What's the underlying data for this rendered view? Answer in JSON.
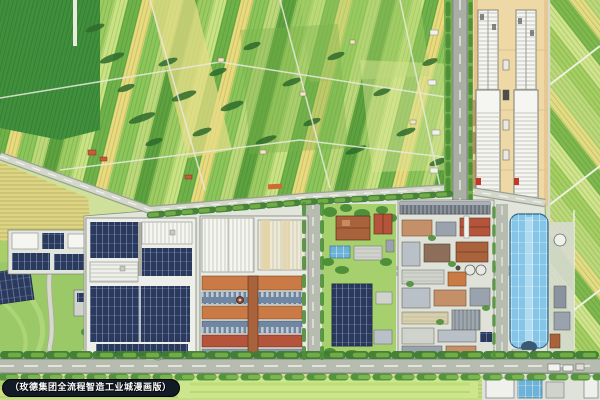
{
  "caption": {
    "label": "（玫德集团全流程智造工业城漫画版）"
  },
  "palette": {
    "farm_green": "#8cc65a",
    "farm_green_dark": "#3f8f3c",
    "farm_yellow": "#e9da7d",
    "hedge_dark": "#2f6b2c",
    "road_gray": "#b7bcb0",
    "yard_tan": "#eed9a6",
    "roof_white": "#f5f5f1",
    "solar_navy": "#2b3a5c",
    "blue_building": "#85c6e8",
    "brick_orange": "#c97a45",
    "brick_red": "#b4543a",
    "tree_green": "#4e8f3a",
    "concrete": "#e2e5dc",
    "badge_bg": "#121a26",
    "badge_text": "#ffffff"
  }
}
